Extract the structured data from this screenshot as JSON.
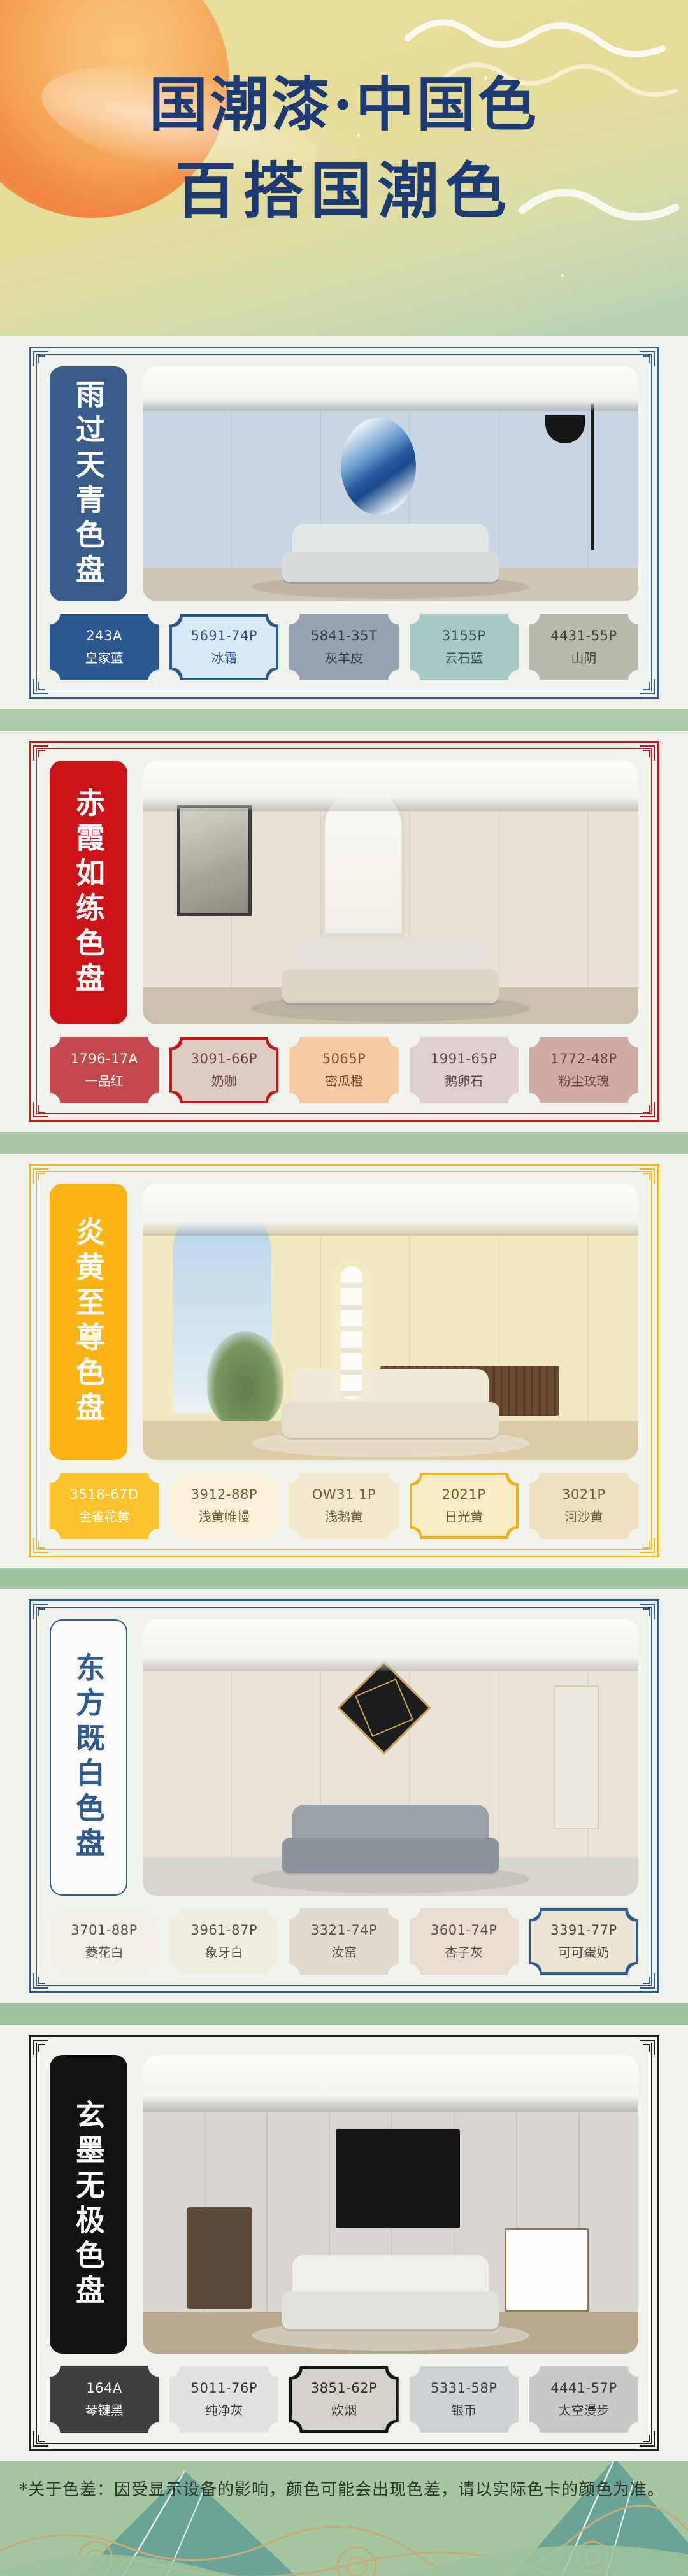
{
  "poster": {
    "title_line1": "国潮漆·中国色",
    "title_line2": "百搭国潮色"
  },
  "sections": [
    {
      "title": "雨过天青色盘",
      "accent_color": "#3a5c8c",
      "banner": {
        "bg": "#3a5c8c",
        "text_color": "#ffffff",
        "border_color": "#3a5c8c"
      },
      "swatches": [
        {
          "code": "243A",
          "name": "皇家蓝",
          "fill": "#2d5791",
          "text_color": "#ffffff"
        },
        {
          "code": "5691-74P",
          "name": "冰霜",
          "fill": "#dbe8f5",
          "text_color": "#2d5791",
          "border_color": "#2d5791"
        },
        {
          "code": "5841-35T",
          "name": "灰羊皮",
          "fill": "#96a1b2",
          "text_color": "#2c3b52"
        },
        {
          "code": "3155P",
          "name": "云石蓝",
          "fill": "#a7c9c6",
          "text_color": "#37514f"
        },
        {
          "code": "4431-55P",
          "name": "山阴",
          "fill": "#b6bbad",
          "text_color": "#3f4639"
        }
      ]
    },
    {
      "title": "赤霞如练色盘",
      "accent_color": "#c5181c",
      "banner": {
        "bg": "#cb1418",
        "text_color": "#ffffff",
        "border_color": "#cb1418"
      },
      "swatches": [
        {
          "code": "1796-17A",
          "name": "一品红",
          "fill": "#c5484c",
          "text_color": "#ffffff"
        },
        {
          "code": "3091-66P",
          "name": "奶咖",
          "fill": "#ddccc3",
          "text_color": "#74443a",
          "border_color": "#c5181c"
        },
        {
          "code": "5065P",
          "name": "密瓜橙",
          "fill": "#f5c9a3",
          "text_color": "#7c512f"
        },
        {
          "code": "1991-65P",
          "name": "鹅卵石",
          "fill": "#ded0d0",
          "text_color": "#5c4a4a"
        },
        {
          "code": "1772-48P",
          "name": "粉尘玫瑰",
          "fill": "#d2aaa8",
          "text_color": "#6d413f"
        }
      ]
    },
    {
      "title": "炎黄至尊色盘",
      "accent_color": "#f3b71b",
      "banner": {
        "bg": "#fcb414",
        "text_color": "#ffffff",
        "border_color": "#fcb414"
      },
      "swatches": [
        {
          "code": "3518-67D",
          "name": "金雀花黄",
          "fill": "#fcc22c",
          "text_color": "#ffffff"
        },
        {
          "code": "3912-88P",
          "name": "浅黄帷幔",
          "fill": "#f8f1d8",
          "text_color": "#70603a"
        },
        {
          "code": "OW31 1P",
          "name": "浅鹅黄",
          "fill": "#f3e9cf",
          "text_color": "#70603a"
        },
        {
          "code": "2021P",
          "name": "日光黄",
          "fill": "#f8edc4",
          "text_color": "#6d5a28",
          "border_color": "#f0b11a"
        },
        {
          "code": "3021P",
          "name": "河沙黄",
          "fill": "#efdfc0",
          "text_color": "#70603a"
        }
      ]
    },
    {
      "title": "东方既白色盘",
      "accent_color": "#2f5b90",
      "banner": {
        "bg": "#fcfdfb",
        "text_color": "#2f5b90",
        "border_color": "#2f5b90"
      },
      "swatches": [
        {
          "code": "3701-88P",
          "name": "菱花白",
          "fill": "#f2ede5",
          "text_color": "#55524c"
        },
        {
          "code": "3961-87P",
          "name": "象牙白",
          "fill": "#f1ece0",
          "text_color": "#55524c"
        },
        {
          "code": "3321-74P",
          "name": "汝窑",
          "fill": "#e3dbd0",
          "text_color": "#55524c"
        },
        {
          "code": "3601-74P",
          "name": "杏子灰",
          "fill": "#e8ddd0",
          "text_color": "#55524c"
        },
        {
          "code": "3391-77P",
          "name": "可可蛋奶",
          "fill": "#ece4d3",
          "text_color": "#474743",
          "border_color": "#2f5b90"
        }
      ]
    },
    {
      "title": "玄墨无极色盘",
      "accent_color": "#1f1f1f",
      "banner": {
        "bg": "#121212",
        "text_color": "#ffffff",
        "border_color": "#121212"
      },
      "swatches": [
        {
          "code": "164A",
          "name": "琴键黑",
          "fill": "#3f3f3f",
          "text_color": "#ffffff"
        },
        {
          "code": "5011-76P",
          "name": "纯净灰",
          "fill": "#e4e2e0",
          "text_color": "#3a3a3a"
        },
        {
          "code": "3851-62P",
          "name": "炊烟",
          "fill": "#d6d2ca",
          "text_color": "#2c2c2c",
          "border_color": "#161616"
        },
        {
          "code": "5331-58P",
          "name": "银币",
          "fill": "#cdd3d5",
          "text_color": "#3a3a3a"
        },
        {
          "code": "4441-57P",
          "name": "太空漫步",
          "fill": "#c9c9c7",
          "text_color": "#3a3a3a"
        }
      ]
    }
  ],
  "footer": {
    "disclaimer": "*关于色差：因受显示设备的影响，颜色可能会出现色差，请以实际色卡的颜色为准。"
  }
}
